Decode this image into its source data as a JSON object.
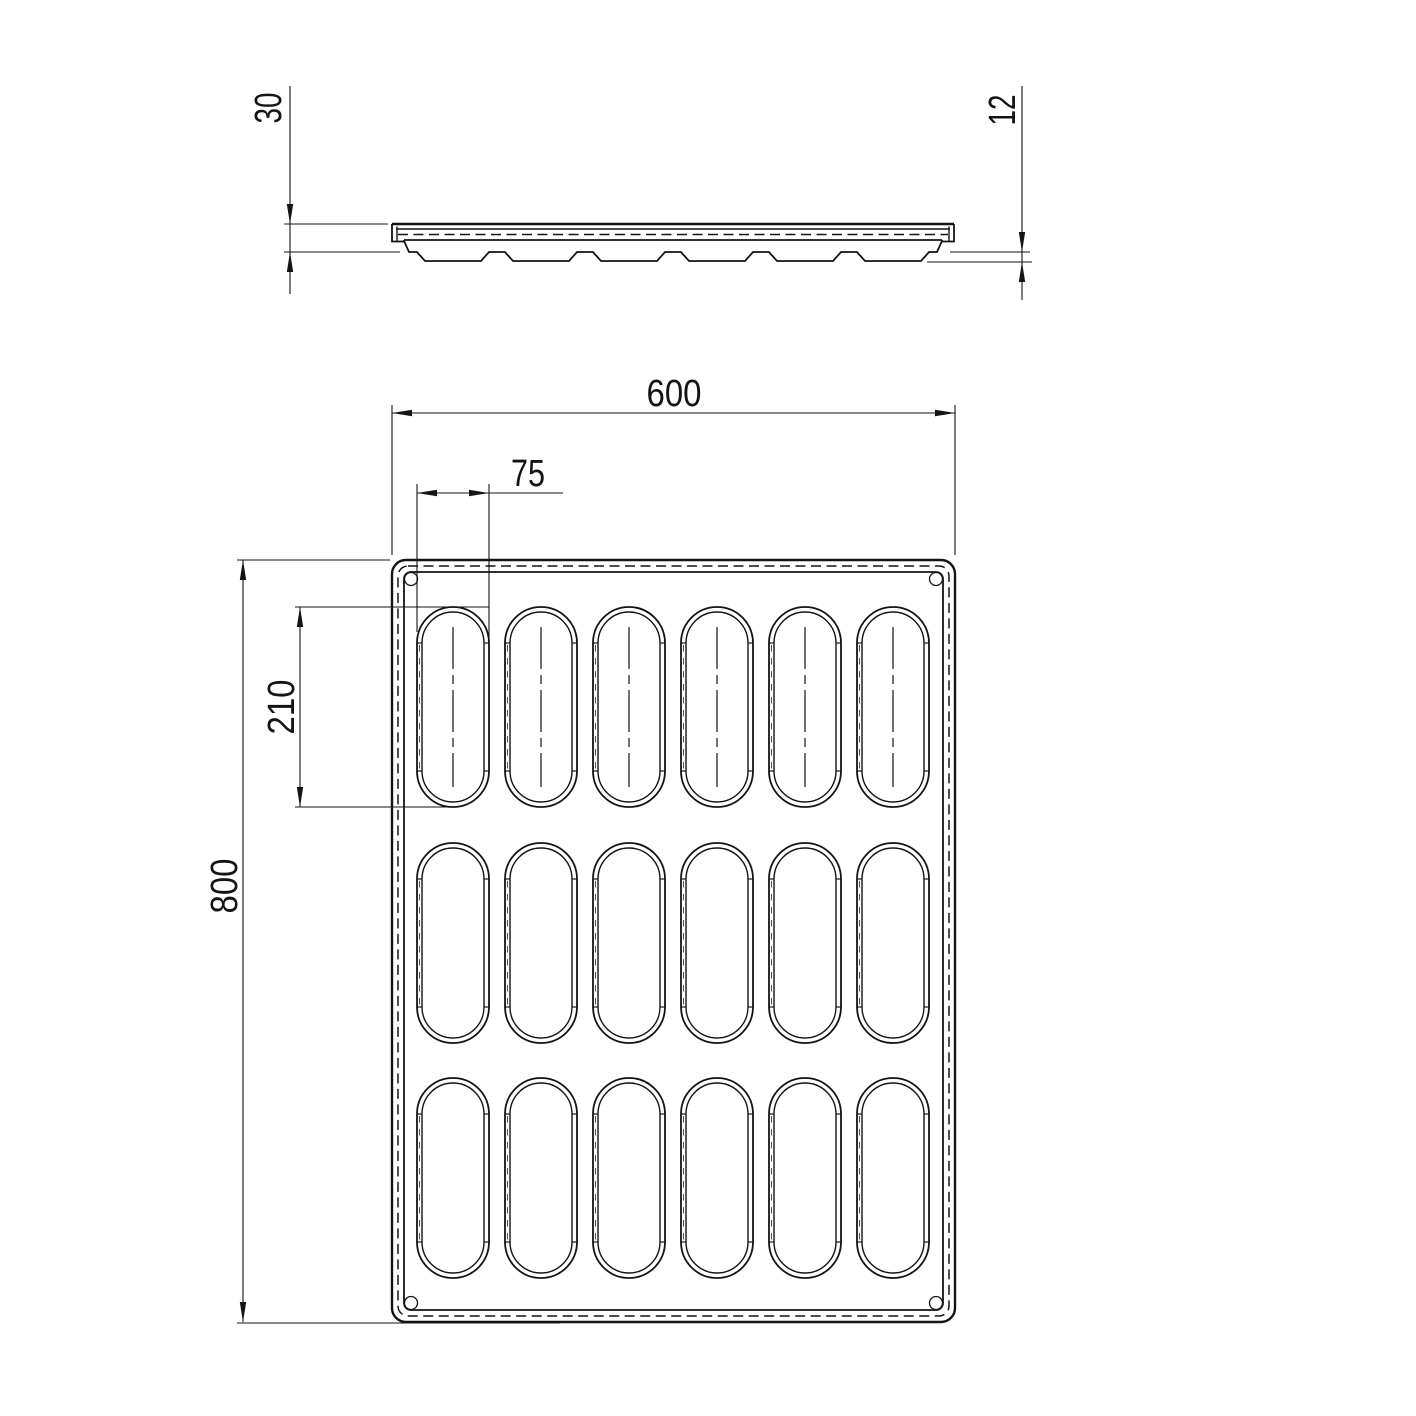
{
  "drawing": {
    "background": "#ffffff",
    "line_color": "#141414"
  },
  "cavity_grid": {
    "columns": 6,
    "rows": 3,
    "total_cavities": 18,
    "cavity_shape": "stadium"
  },
  "dimensions": {
    "tray_width": "600",
    "tray_length": "800",
    "cavity_width": "75",
    "cavity_length": "210",
    "tray_height": "30",
    "cavity_bump_depth": "12"
  }
}
